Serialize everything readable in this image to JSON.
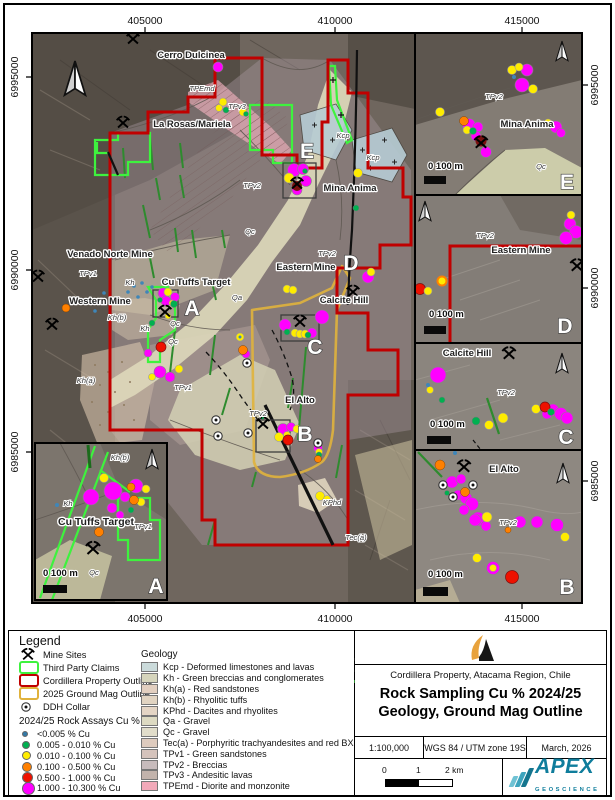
{
  "axes": {
    "top": [
      "405000",
      "410000",
      "415000"
    ],
    "bottom": [
      "405000",
      "410000",
      "415000"
    ],
    "left": [
      "6995000",
      "6990000",
      "6985000"
    ],
    "right": [
      "6995000",
      "6990000",
      "6985000"
    ]
  },
  "labels": {
    "places": {
      "cerro": "Cerro Dulcinea",
      "larosas": "La Rosas/Mariela",
      "mina": "Mina Anima",
      "venado": "Venado Norte Mine",
      "western": "Western Mine",
      "cutuffs": "Cu Tuffs Target",
      "eastern": "Eastern Mine",
      "calcite": "Calcite Hill",
      "elalto": "El Alto"
    },
    "geology": {
      "tpemd": "TPEmd",
      "tpv3": "TPv3",
      "tpv2": "TPv2",
      "tpv1": "TPv1",
      "kcp": "Kcp",
      "qc": "Qc",
      "qa": "Qa",
      "kh": "Kh",
      "kha": "Kh(a)",
      "khb": "Kh(b)",
      "kphd": "KPhd",
      "teca": "Tec(a)"
    },
    "letters": {
      "a": "A",
      "b": "B",
      "c": "C",
      "d": "D",
      "e": "E"
    },
    "inset_scale": "0  100 m"
  },
  "legend": {
    "title": "Legend",
    "items": {
      "mine_sites": "Mine Sites",
      "claims": "Third Party Claims",
      "property": "Cordillera Property Outline",
      "mag": "2025 Ground Mag Outline",
      "ddh": "DDH Collar"
    },
    "assays_header": "2024/25 Rock Assays Cu %",
    "assays": [
      {
        "label": "<0.005 % Cu",
        "color": "#3379a6",
        "size": 4
      },
      {
        "label": "0.005 - 0.010 % Cu",
        "color": "#00b050",
        "size": 6
      },
      {
        "label": "0.010 - 0.100 % Cu",
        "color": "#ffec00",
        "size": 7
      },
      {
        "label": "0.100 - 0.500 % Cu",
        "color": "#ff8000",
        "size": 8
      },
      {
        "label": "0.500 - 1.000 % Cu",
        "color": "#ee1100",
        "size": 9
      },
      {
        "label": "1.000 - 10.300 % Cu",
        "color": "#ff00ff",
        "size": 11
      }
    ],
    "geology_header": "Geology",
    "geology": [
      {
        "label": "Kcp - Deformed limestones and lavas",
        "color": "#cbdbdb"
      },
      {
        "label": "Kh - Green breccias and conglomerates",
        "color": "#d6d5bc"
      },
      {
        "label": "Kh(a) - Red sandstones",
        "color": "#e2cfc0"
      },
      {
        "label": "Kh(b) - Rhyolitic tuffs",
        "color": "#e1d4c2"
      },
      {
        "label": "KPhd - Dacites and rhyolites",
        "color": "#e4d5c5"
      },
      {
        "label": "Qa - Gravel",
        "color": "#dddac2"
      },
      {
        "label": "Qc - Gravel",
        "color": "#e1ddca"
      },
      {
        "label": "Tec(a) - Porphyritic trachyandesites and red BX",
        "color": "#decbbe"
      },
      {
        "label": "TPv1 - Green sandstones",
        "color": "#d5c3bc"
      },
      {
        "label": "TPv2 - Breccias",
        "color": "#c7bbbc"
      },
      {
        "label": "TPv3 - Andesitic lavas",
        "color": "#c2b3ac"
      },
      {
        "label": "TPEmd - Diorite and monzonite",
        "color": "#f2a9b9"
      }
    ],
    "lines": {
      "faults": "Faults",
      "folds": "Folds",
      "dykes": "Dykes"
    }
  },
  "title_block": {
    "subtitle": "Cordillera Property, Atacama Region, Chile",
    "title_line1": "Rock Sampling Cu % 2024/25",
    "title_line2": "Geology, Ground Mag Outline",
    "scale": "1:100,000",
    "datum": "WGS 84 / UTM zone 19S",
    "date": "March, 2026",
    "scalebar": {
      "t0": "0",
      "t1": "1",
      "t2": "2 km"
    },
    "apex": "APEX",
    "apex_sub": "GEOSCIENCE"
  },
  "colors": {
    "property_outline": "#c00000",
    "third_party_claims": "#3ef23e",
    "ground_mag_outline": "#e0b23c",
    "dykes": "#2e8b2e",
    "faults": "#111111",
    "apex_teal": "#0f7d9c",
    "logo_orange": "#e8a23c"
  }
}
